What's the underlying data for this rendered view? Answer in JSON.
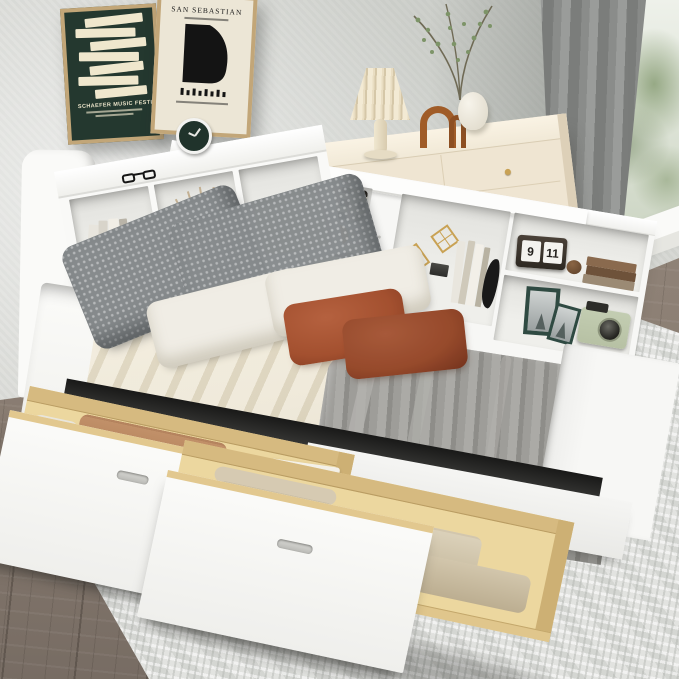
{
  "posters": {
    "left": {
      "title": "SCHAEFER MUSIC FESTIVAL"
    },
    "right": {
      "title": "SAN SEBASTIAN"
    }
  },
  "flip_clock": {
    "hour": "9",
    "minute": "11"
  },
  "palette": {
    "wall": "#d8d9d5",
    "floor_wood": "#8b7e73",
    "rug": "#e2e3e0",
    "curtain": "#8a8c8a",
    "window_frame": "#b9722f",
    "poster_green_bg": "#24382f",
    "poster_cream_bg": "#ece6d6",
    "poster_bar": "#efe7cd",
    "dresser": "#efe5d2",
    "lamp_shade": "#e9ddc2",
    "arch_wood": "#a05c28",
    "bed_white": "#f7f7f5",
    "mattress_white": "#fbfbf9",
    "sheet_beige": "#e9e1cc",
    "blanket_gray": "#9e9d99",
    "pillow_gray": "#878b8d",
    "pillow_white": "#f0ede5",
    "pillow_rust": "#a3502f",
    "drawer_wood": "#ecd79f",
    "gold": "#c9a254",
    "frame_green": "#2f4a42",
    "camera_sage": "#b7c1a4"
  }
}
